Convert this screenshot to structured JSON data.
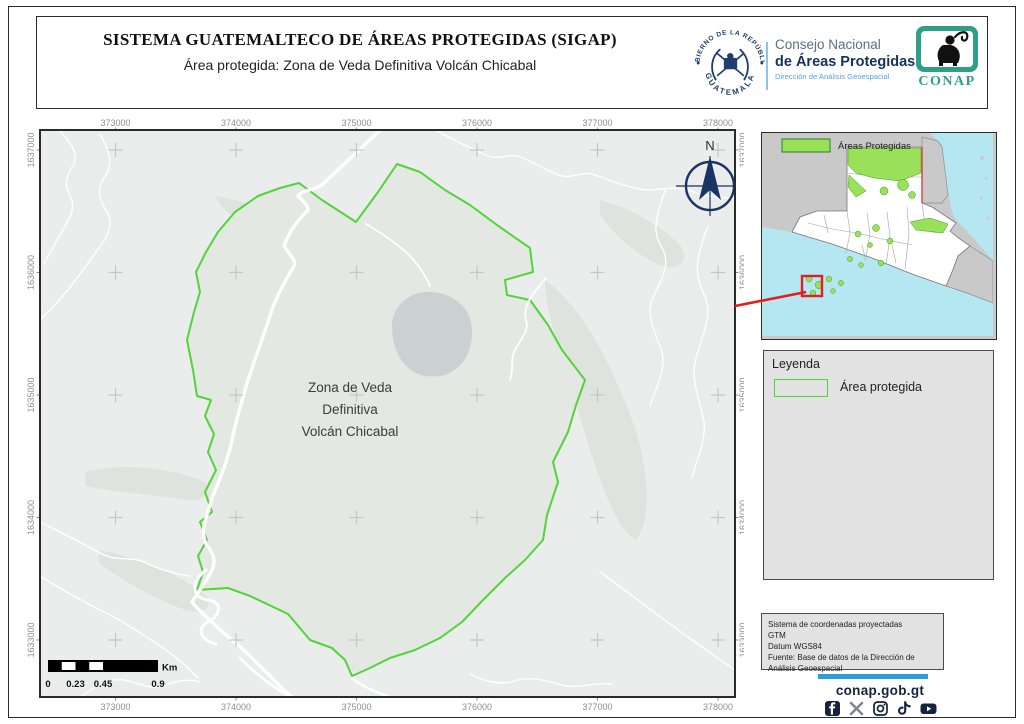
{
  "header": {
    "title": "SISTEMA GUATEMALTECO DE ÁREAS PROTEGIDAS (SIGAP)",
    "subtitle": "Área protegida: Zona de Veda Definitiva Volcán Chicabal",
    "seal": {
      "arc_top": "GOBIERNO DE LA REPÚBLICA",
      "arc_bottom": "GUATEMALA"
    },
    "org": {
      "line1": "Consejo Nacional",
      "line2": "de Áreas Protegidas",
      "line3": "Dirección de Análisis Geoespacial"
    },
    "conap_acronym": "CONAP"
  },
  "map": {
    "x_ticks": [
      "373000",
      "374000",
      "375000",
      "376000",
      "377000",
      "378000"
    ],
    "y_ticks": [
      "1637000",
      "1636000",
      "1635000",
      "1634000",
      "1633000"
    ],
    "area_label_lines": [
      "Zona de Veda",
      "Definitiva",
      "Volcán Chicabal"
    ],
    "north_label": "N",
    "scalebar": {
      "tick_labels": [
        "0",
        "0.23",
        "0.45",
        "0.9"
      ],
      "unit": "Km"
    }
  },
  "inset": {
    "legend_label": "Áreas Protegidas"
  },
  "legend": {
    "title": "Leyenda",
    "items": [
      {
        "label": "Área protegida",
        "swatch_color": "#52d43a"
      }
    ]
  },
  "info_box": {
    "lines": [
      "Sistema de coordenadas proyectadas",
      "GTM",
      "Datum WGS84",
      "Fuente: Base de datos de la Dirección de Análisis Geoespacial"
    ]
  },
  "footer": {
    "website": "conap.gob.gt",
    "social_icons": [
      "facebook-icon",
      "x-icon",
      "instagram-icon",
      "tiktok-icon",
      "youtube-icon"
    ]
  },
  "colors": {
    "protected_area_outline": "#52d43a",
    "inset_protected_fill": "#98e159",
    "navy": "#15233f",
    "accent_blue_bar": "#2e9fd6",
    "locator_red": "#e51d1d",
    "water": "#b5e7f3"
  }
}
